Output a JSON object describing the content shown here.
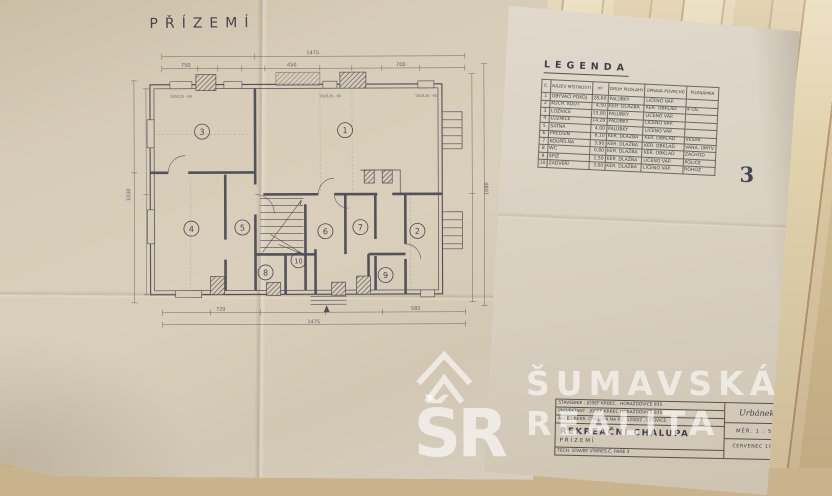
{
  "floorplan": {
    "title": "PŘÍZEMÍ",
    "rooms": [
      "1",
      "2",
      "3",
      "4",
      "5",
      "6",
      "7",
      "8",
      "9",
      "10"
    ],
    "dims": {
      "top_total": "1475",
      "top_a": "750",
      "top_b": "450",
      "top_c": "700",
      "left_total": "1030",
      "right_total": "1080",
      "bottom_total": "1475",
      "bottom_a": "720",
      "bottom_b": "585"
    },
    "window_label": "150/120 - 90"
  },
  "legend": {
    "heading": "LEGENDA",
    "page_number": "3",
    "columns": [
      "Č.",
      "NÁZEV MÍSTNOSTI",
      "m²",
      "DRUH PODLAHY",
      "ÚPRAVA POVRCHŮ",
      "POZNÁMKA"
    ],
    "rows": [
      [
        "1",
        "OBÝVACÍ POKOJ",
        "28,60",
        "PALUBKY",
        "LÍČENO VÁP.",
        ""
      ],
      [
        "2",
        "KUCH. KOUT",
        "4,50",
        "KER. DLAŽBA",
        "KER. OBKLAD",
        "4 OS."
      ],
      [
        "3",
        "LOŽNICE",
        "15,80",
        "PALUBKY",
        "LÍČENO VÁP.",
        ""
      ],
      [
        "4",
        "LOŽNICE",
        "14,20",
        "PALUBKY",
        "LÍČENO VÁP.",
        ""
      ],
      [
        "5",
        "ŠATNA",
        "4,00",
        "PALUBKY",
        "LÍČENO VÁP.",
        ""
      ],
      [
        "6",
        "PŘEDSÍŇ",
        "8,10",
        "KER. DLAŽBA",
        "KER. OBKLAD",
        "VĚŠÁK"
      ],
      [
        "7",
        "KOUPELNA",
        "3,90",
        "KER. DLAŽBA",
        "KER. OBKLAD",
        "VANA, UMYV."
      ],
      [
        "8",
        "WC",
        "0,80",
        "KER. DLAŽBA",
        "KER. OBKLAD",
        "ZÁCHOD"
      ],
      [
        "9",
        "SPÍŽ",
        "1,50",
        "KER. DLAŽBA",
        "LÍČENO VÁP.",
        "POLICE"
      ],
      [
        "10",
        "ZÁDVEŘÍ",
        "3,00",
        "KER. DLAŽBA",
        "LÍČENO VÁP.",
        "ROHOŽ"
      ]
    ]
  },
  "title_block": {
    "stavebnik_line": "STAVEBNÍK :  JOSEF KRBEC , HORAŽĎOVICE 835",
    "projektant_line": "PROJEKTANT :  JOSEF KRBEC  HORAŽĎOVICE  835",
    "akce_line": "AKCE :  REKR. CHALUPA NA P.Č. 1200/2 , LIPOVICE",
    "main_title": "REKREAČNÍ CHALUPA",
    "subtitle": "PŘÍZEMÍ",
    "bottom_line": "TECH. STAVBY     VÝKRES Č.     PARÉ  3",
    "signature": "Urbánek",
    "scale": "MĚŘ.  1 : 50",
    "date": "ČERVENEC 1985"
  },
  "watermark": {
    "line1": "ŠUMAVSKÁ",
    "line2": "REALITA",
    "monogram": "ŠR"
  },
  "colors": {
    "wood": "#d2bc93",
    "paper_left": "#d7ccb7",
    "paper_right": "#d9d1c2",
    "ink": "#4e4e58",
    "watermark_white": "rgba(255,255,255,0.6)"
  }
}
